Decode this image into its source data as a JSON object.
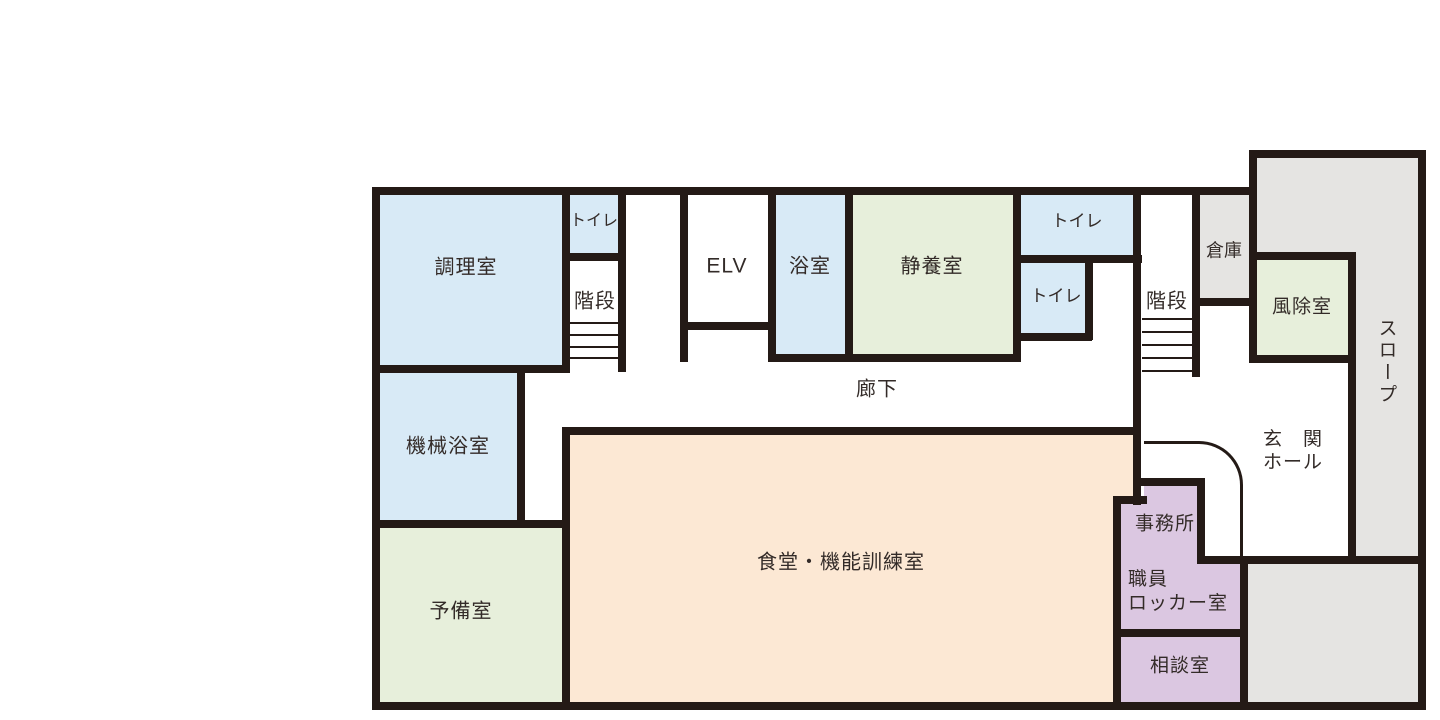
{
  "floorplan": {
    "title": "施設平面図",
    "rooms": {
      "kitchen": {
        "label": "調理室"
      },
      "toilet_left": {
        "label": "トイレ"
      },
      "stairs_left": {
        "label": "階段"
      },
      "elevator": {
        "label": "ELV"
      },
      "bath": {
        "label": "浴室"
      },
      "rest_room": {
        "label": "静養室"
      },
      "toilet_right_upper": {
        "label": "トイレ"
      },
      "toilet_right_lower": {
        "label": "トイレ"
      },
      "stairs_right": {
        "label": "階段"
      },
      "storage": {
        "label": "倉庫"
      },
      "windbreak_room": {
        "label": "風除室"
      },
      "slope": {
        "label": "スロープ"
      },
      "entrance_hall": {
        "label_line1": "玄　関",
        "label_line2": "ホール"
      },
      "corridor": {
        "label": "廊下"
      },
      "machine_bath": {
        "label": "機械浴室"
      },
      "spare_room": {
        "label": "予備室"
      },
      "dining_training": {
        "label": "食堂・機能訓練室"
      },
      "office": {
        "label": "事務所"
      },
      "staff_locker": {
        "label_line1": "職員",
        "label_line2": "ロッカー室"
      },
      "consultation": {
        "label": "相談室"
      }
    },
    "colors": {
      "wall": "#241a16",
      "room_blue": "#d8eaf6",
      "room_green": "#e7efdb",
      "room_peach": "#fce8d4",
      "room_purple": "#dbc7e1",
      "room_gray": "#e5e4e2",
      "background": "#ffffff",
      "text": "#332b28"
    }
  }
}
